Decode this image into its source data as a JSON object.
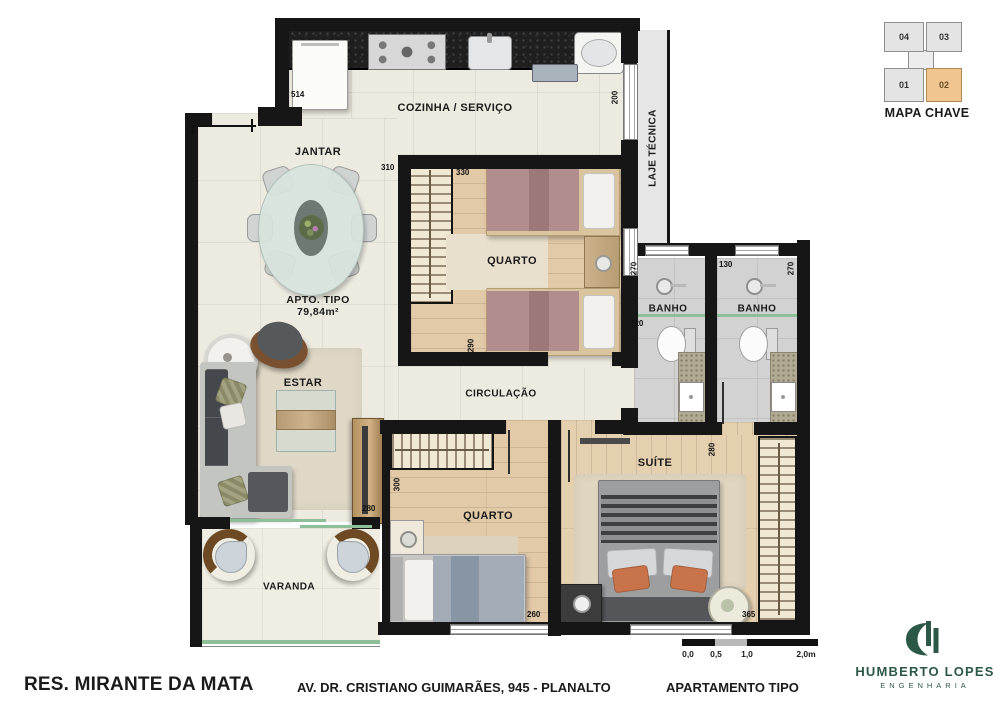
{
  "key_map": {
    "title": "MAPA CHAVE",
    "units": [
      {
        "label": "04",
        "highlighted": false
      },
      {
        "label": "03",
        "highlighted": false
      },
      {
        "label": "01",
        "highlighted": false
      },
      {
        "label": "02",
        "highlighted": true
      }
    ]
  },
  "rooms": {
    "kitchen": "COZINHA / SERVIÇO",
    "dining": "JANTAR",
    "unit_type": "APTO. TIPO",
    "unit_area": "79,84m²",
    "bedroom1": "QUARTO",
    "laje": "LAJE TÉCNICA",
    "bath1": "BANHO",
    "bath2": "BANHO",
    "hall": "CIRCULAÇÃO",
    "living": "ESTAR",
    "bedroom2": "QUARTO",
    "suite": "SUÍTE",
    "balcony": "VARANDA"
  },
  "dims": {
    "kitchen_left": "514",
    "living_wall": "602",
    "dining_side": "310",
    "bedroom1_top": "330",
    "laje_side": "200",
    "bedroom1_depth": "290",
    "bath1_top": "270",
    "bath1_side": "120",
    "bath2_left": "130",
    "bath2_right": "270",
    "tv_wall": "280",
    "bedroom2_side": "300",
    "bedroom2_bottom": "260",
    "suite_entry": "280",
    "suite_bottom": "365"
  },
  "scale_bar": {
    "labels": [
      "0,0",
      "0,5",
      "1,0",
      "2,0m"
    ]
  },
  "footer": {
    "project": "RES. MIRANTE DA MATA",
    "address": "AV. DR. CRISTIANO GUIMARÃES, 945 - PLANALTO",
    "plan_name": "APARTAMENTO TIPO"
  },
  "logo": {
    "name": "HUMBERTO LOPES",
    "subtitle": "ENGENHARIA"
  },
  "colors": {
    "highlight_unit": "#f0c58f",
    "logo_green": "#2c5847",
    "wall": "#161616",
    "glass": "#8fbf98"
  }
}
